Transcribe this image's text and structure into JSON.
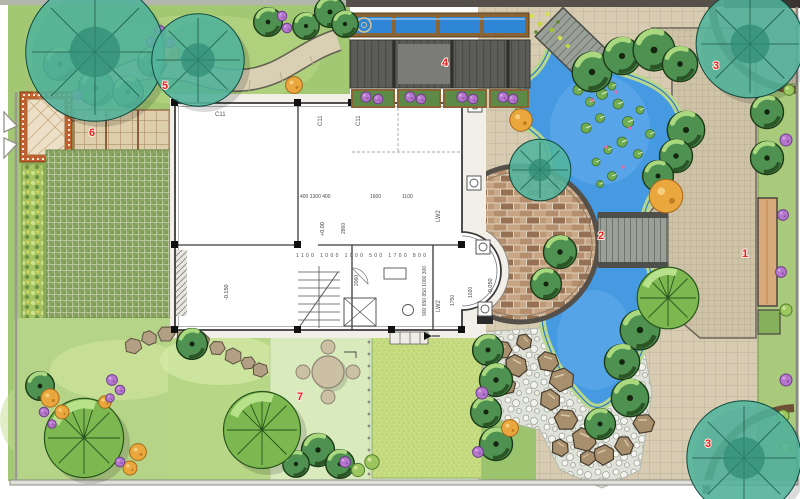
{
  "plan": {
    "type": "residential-landscape-plan",
    "zones": [
      {
        "id": "1",
        "name": "east-paved-plaza"
      },
      {
        "id": "2",
        "name": "wood-bridge"
      },
      {
        "id": "3",
        "name": "corner-tree-planters"
      },
      {
        "id": "4",
        "name": "pergola-deck"
      },
      {
        "id": "5",
        "name": "winding-garden-path"
      },
      {
        "id": "6",
        "name": "grid-paving-court"
      },
      {
        "id": "7",
        "name": "garden-seating-area"
      }
    ]
  },
  "zone_labels": {
    "plaza": "1",
    "bridge": "2",
    "corner_top": "3",
    "corner_bottom": "3",
    "pergola": "4",
    "path": "5",
    "paving": "6",
    "seating": "7"
  },
  "house": {
    "window_tags": [
      "C11",
      "C11",
      "C11",
      "LW2",
      "LW2"
    ],
    "levels": {
      "main": "+0.00",
      "porch": "-0.150",
      "bay": "-0.050"
    },
    "dims": {
      "top_left": "400 1300 400",
      "top_mid": "1600",
      "top_right": "1100",
      "mid_row": "1100 1000 1000 500 1700 800",
      "v1": "2860",
      "v2": "2060",
      "right_col": "900 650 650 1000 300",
      "bay1": "1020",
      "bay2": "1750"
    }
  },
  "palette": {
    "pond_blue": "#459ae2",
    "water_channel_blue": "#2f85d6",
    "garden_green": "#a2c873",
    "lawn_bright": "#c8dd83",
    "lawn_pale": "#d9ebbc",
    "tree_teal": "#52b49c",
    "tree_green": "#4e9150",
    "shrub_purple": "#b577cb",
    "shrub_orange": "#eaa73e",
    "paving_tan": "#d7cbb2",
    "brick_plaza": "#c8b191",
    "wood_deck_gray": "#9aa098",
    "pergola_gray": "#5c5c58",
    "wood_frame_brown": "#8a6434",
    "patio_border_rust": "#c2602f",
    "label_red": "#e8251d"
  }
}
